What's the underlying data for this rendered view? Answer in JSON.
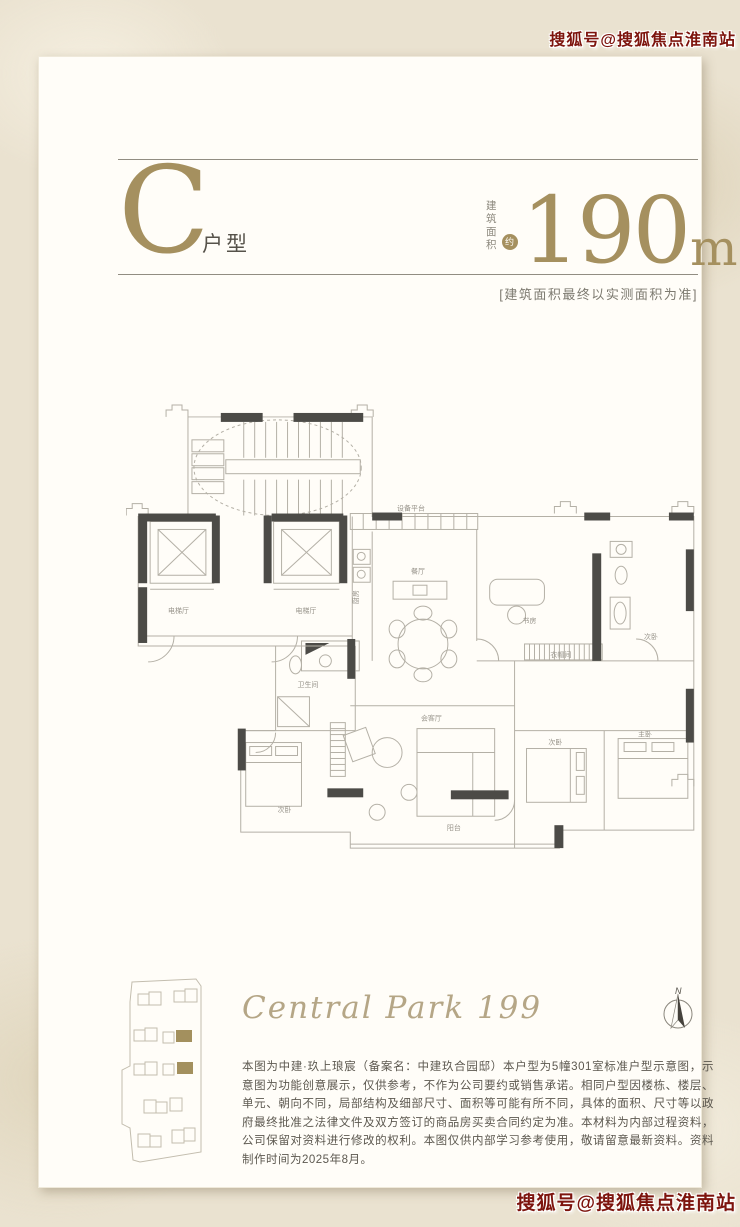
{
  "watermark": {
    "top": "搜狐号@搜狐焦点淮南站",
    "bottom": "搜狐号@搜狐焦点淮南站"
  },
  "header": {
    "unit_letter": "C",
    "unit_type_label": "户型",
    "area_label_line1": "建筑",
    "area_label_line2": "面积",
    "area_badge": "约",
    "area_value": "190",
    "area_unit": "m",
    "area_exponent": "2",
    "area_note": "[建筑面积最终以实测面积为准]"
  },
  "floorplan": {
    "rooms": [
      {
        "label": "电梯厅"
      },
      {
        "label": "电梯厅"
      },
      {
        "label": "设备平台"
      },
      {
        "label": "厨房"
      },
      {
        "label": "餐厅"
      },
      {
        "label": "书房"
      },
      {
        "label": "次卧"
      },
      {
        "label": "会客厅"
      },
      {
        "label": "次卧"
      },
      {
        "label": "主卧"
      },
      {
        "label": "次卧"
      },
      {
        "label": "阳台"
      },
      {
        "label": "卫生间"
      },
      {
        "label": "衣帽间"
      }
    ]
  },
  "footer": {
    "logo": "Central Park 199",
    "compass_label": "N",
    "disclaimer": "本图为中建·玖上琅宸（备案名：中建玖合园邸）本户型为5幢301室标准户型示意图，示意图为功能创意展示，仅供参考，不作为公司要约或销售承诺。相同户型因楼栋、楼层、单元、朝向不同，局部结构及细部尺寸、面积等可能有所不同，具体的面积、尺寸等以政府最终批准之法律文件及双方签订的商品房买卖合同约定为准。本材料为内部过程资料，公司保留对资料进行修改的权利。本图仅供内部学习参考使用，敬请留意最新资料。资料制作时间为2025年8月。"
  },
  "colors": {
    "gold": "#a5905f",
    "wall": "#4c4b47",
    "line": "#b4b0a6",
    "watermark_red": "#7d140d"
  }
}
